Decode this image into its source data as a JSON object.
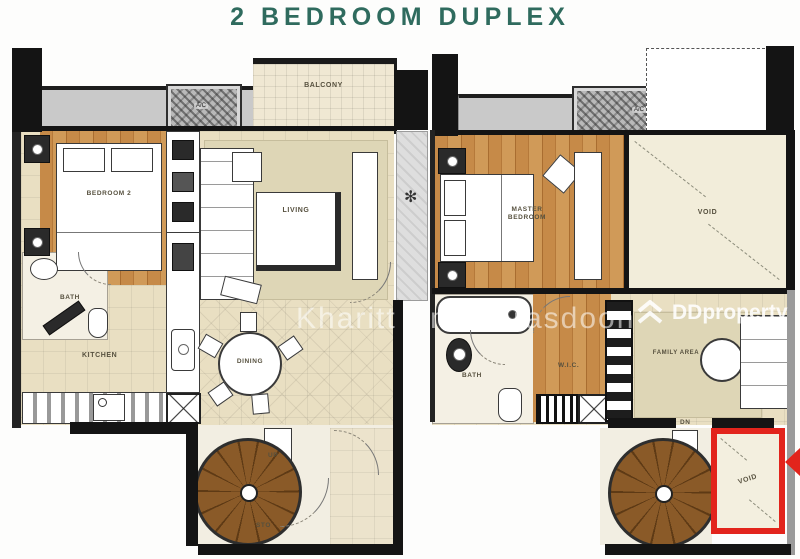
{
  "title": "2 BEDROOM DUPLEX",
  "watermark": {
    "fragment_left": "Kharitt",
    "fragment_right": "m marasdoon",
    "brand": "DDproperty"
  },
  "floor1": {
    "balcony": "BALCONY",
    "ac_unit": "A/C",
    "bedroom2": "BEDROOM 2",
    "living": "LIVING",
    "bath": "BATH",
    "kitchen": "KITCHEN",
    "dining": "DINING",
    "stair_up": "UP",
    "storage": "STO"
  },
  "floor2": {
    "ac_unit": "A/C",
    "master_bedroom": "MASTER BEDROOM",
    "void_upper": "VOID",
    "bath": "BATH",
    "walk_in_closet": "W.I.C.",
    "family_area": "FAMILY AREA",
    "stair_down": "DN",
    "void_highlight": "VOID"
  },
  "colors": {
    "title_green": "#2f6b5e",
    "highlight_red": "#e2241c",
    "wood": "#c68a48",
    "tile_beige": "#e9dfc2",
    "ledge_gray": "#c9c9c9"
  }
}
